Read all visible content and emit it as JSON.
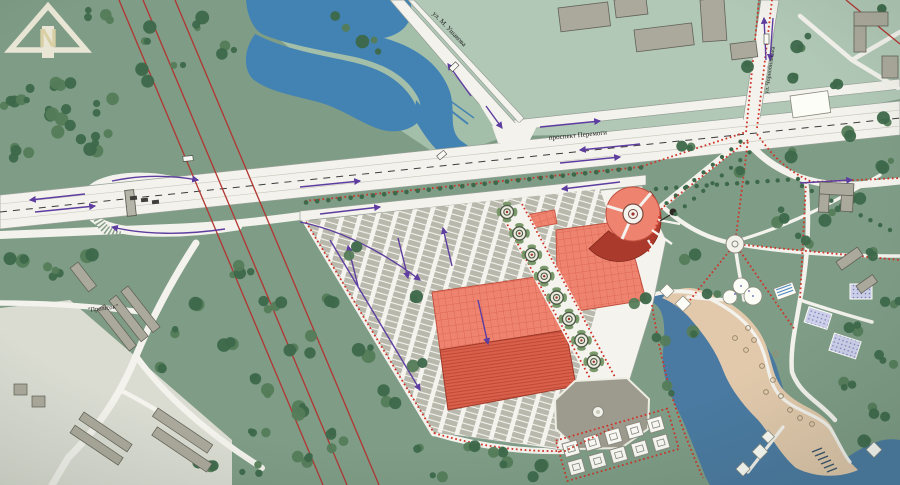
{
  "map": {
    "type": "urban-master-plan",
    "north_label": "N",
    "labels": {
      "street_top": "ул. М. Ушакова",
      "avenue": "проспект Перемоги",
      "street_right": "ул. Чорнобильська",
      "district": "\"Пролісок\""
    }
  },
  "colors": {
    "base": "#7e9c86",
    "block": "#b1c8b6",
    "block2": "#a3bfa9",
    "water": "#4383b4",
    "lake": "#4a7aa2",
    "sand": "#e2c9ac",
    "road": "#f3f2ec",
    "roadedge": "#96a096",
    "rail": "#b23531",
    "dotted": "#cf3226",
    "arrow": "#5d3da0",
    "market": "#ee8470",
    "marketdark": "#d9604b",
    "marketdeep": "#aa3a2b",
    "stall": "#b9b8ac",
    "building": "#aba99b",
    "bldedge": "#62625a",
    "tree": "#3d684a",
    "tree2": "#547c59",
    "plaza": "#a5a496",
    "lightlot": "#dadcd2",
    "centerline": "#3c3c3c"
  }
}
